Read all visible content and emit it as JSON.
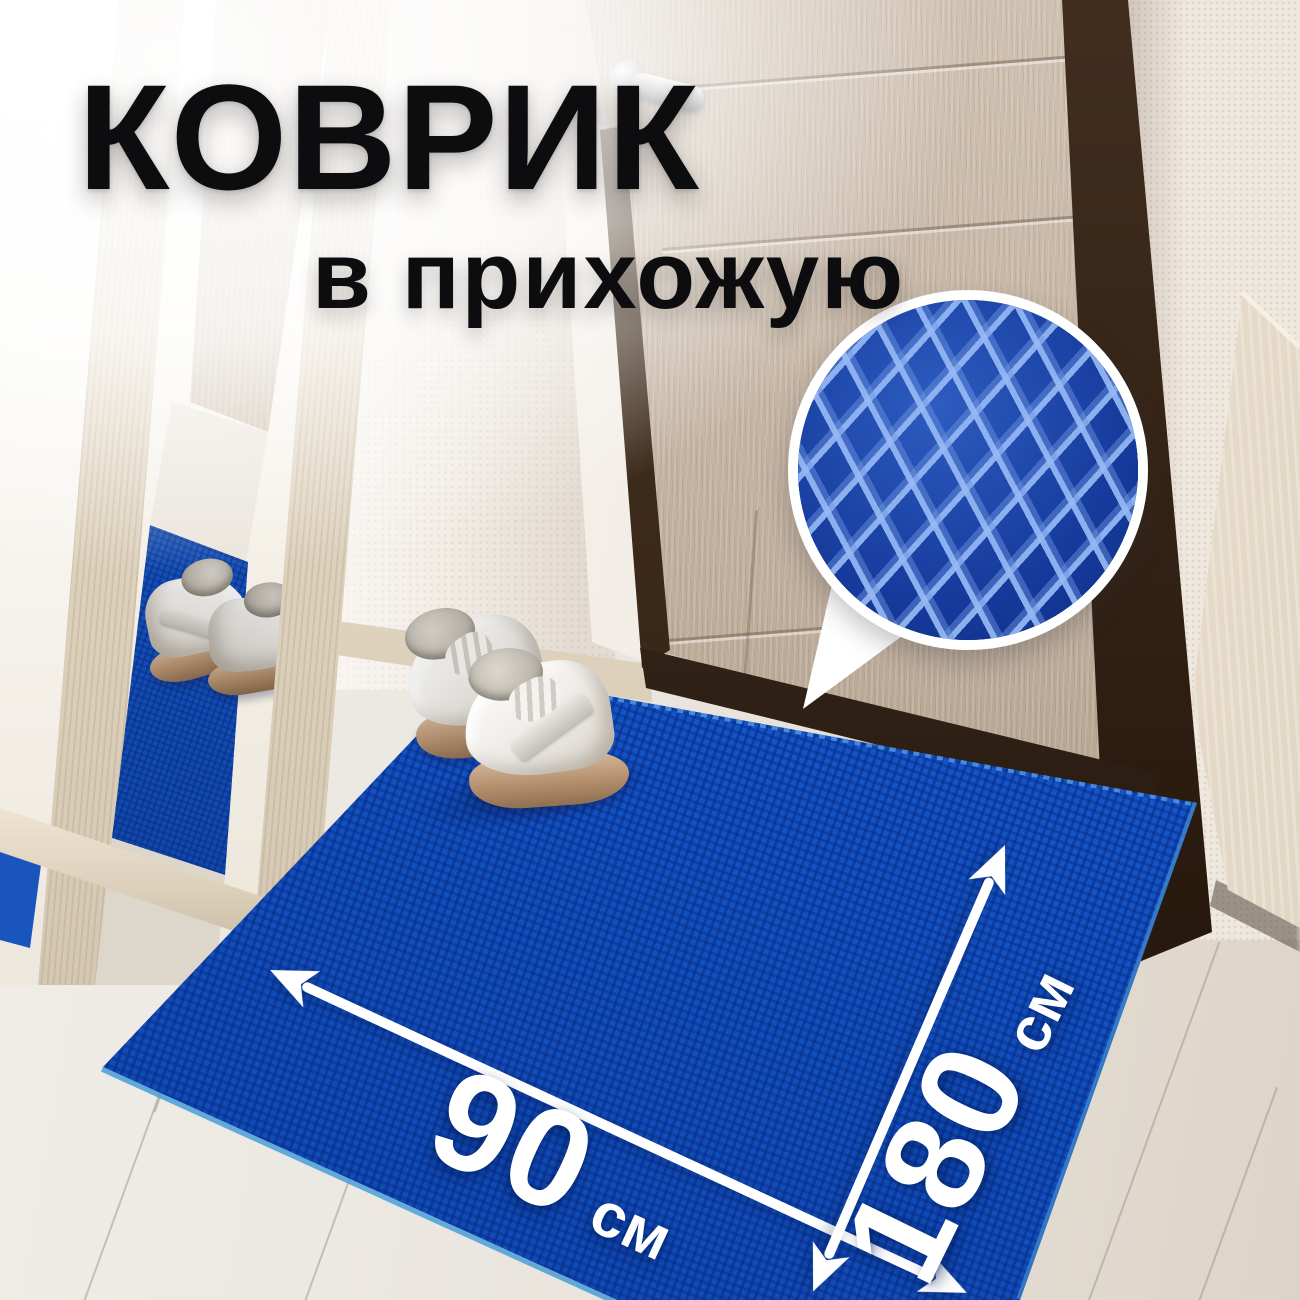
{
  "page": {
    "kind": "product-marketing-image",
    "language": "ru"
  },
  "headline": {
    "title": "КОВРИК",
    "subtitle": "в прихожую"
  },
  "dimensions": {
    "width": {
      "value": "90",
      "unit": "см"
    },
    "length": {
      "value": "180",
      "unit": "см"
    }
  },
  "icons": {
    "width_arrow": "double-headed-dimension-arrow-icon",
    "length_arrow": "double-headed-dimension-arrow-icon",
    "texture_callout": "magnifier-circle-callout-icon"
  },
  "colors": {
    "mat_blue": "#1557cb",
    "mat_cell_dark": "#0a3796",
    "texture_diamond_dark": "#153a9c",
    "texture_line_light": "#96b9f5",
    "title_text": "#0d0d0f",
    "dimension_text": "#ffffff",
    "callout_border": "#ffffff",
    "door_wood": "#bfae9c",
    "door_frame": "#32231a",
    "wall": "#f1ebe3",
    "floor": "#e9e4dc",
    "cabinet_wood": "#e2d8c7"
  }
}
